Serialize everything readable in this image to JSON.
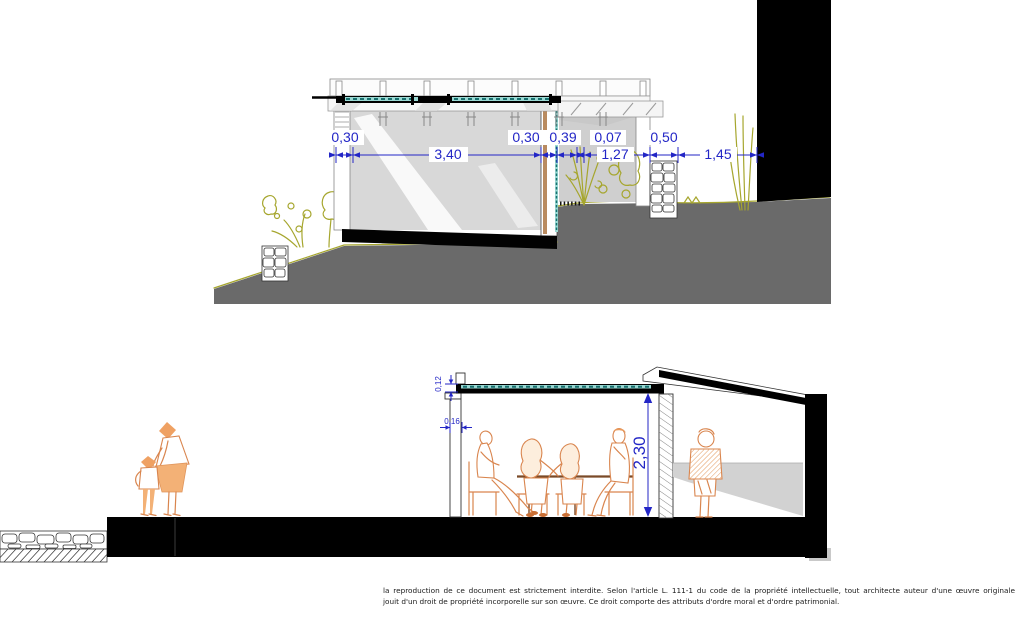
{
  "top_section": {
    "dim_030_left": "0,30",
    "dim_340": "3,40",
    "dim_030_right": "0,30",
    "dim_039": "0,39",
    "dim_007": "0,07",
    "dim_127": "1,27",
    "dim_050": "0,50",
    "dim_145": "1,45"
  },
  "bottom_section": {
    "dim_012": "0,12",
    "dim_016": "0,16",
    "dim_230": "2,30"
  },
  "footer": {
    "line1": "la reproduction de ce document est strictement interdite. Selon l'article L. 111-1 du code de la propriété intellectuelle, tout architecte auteur d'une œuvre originale",
    "line2": "jouit d'un droit de propriété incorporelle sur son œuvre. Ce droit comporte des attributs d'ordre moral et d'ordre patrimonial."
  },
  "colors": {
    "dimension_blue": "#2326c6",
    "glazing_teal": "#17706e",
    "vegetation_olive": "#a6a62e",
    "figure_orange": "#d9854e",
    "ground_gray": "#6a6a6a",
    "wall_gray": "#d8d8d8"
  }
}
